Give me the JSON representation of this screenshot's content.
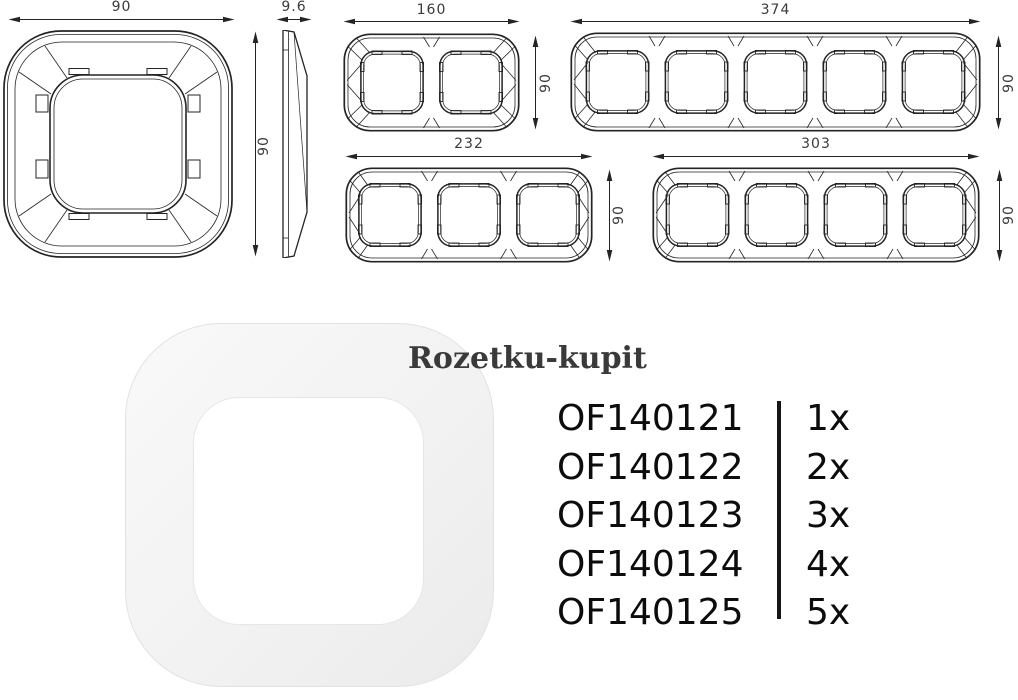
{
  "dims": {
    "single_width": "90",
    "side_thickness": "9.6",
    "side_height": "90",
    "gang2_width": "160",
    "gang2_height": "90",
    "gang3_width": "232",
    "gang3_height": "90",
    "gang4_width": "303",
    "gang4_height": "90",
    "gang5_width": "374",
    "gang5_height": "90"
  },
  "watermark": {
    "text": "Rozetku-kupit"
  },
  "products": [
    {
      "code": "OF140121",
      "qty": "1x"
    },
    {
      "code": "OF140122",
      "qty": "2x"
    },
    {
      "code": "OF140123",
      "qty": "3x"
    },
    {
      "code": "OF140124",
      "qty": "4x"
    },
    {
      "code": "OF140125",
      "qty": "5x"
    }
  ],
  "colors": {
    "line": "#242424",
    "dim_label": "#3a3a3a",
    "product_text": "#0c0c0c",
    "watermark": "#3a3a3a",
    "photo_fill": "#f2f2f2"
  }
}
